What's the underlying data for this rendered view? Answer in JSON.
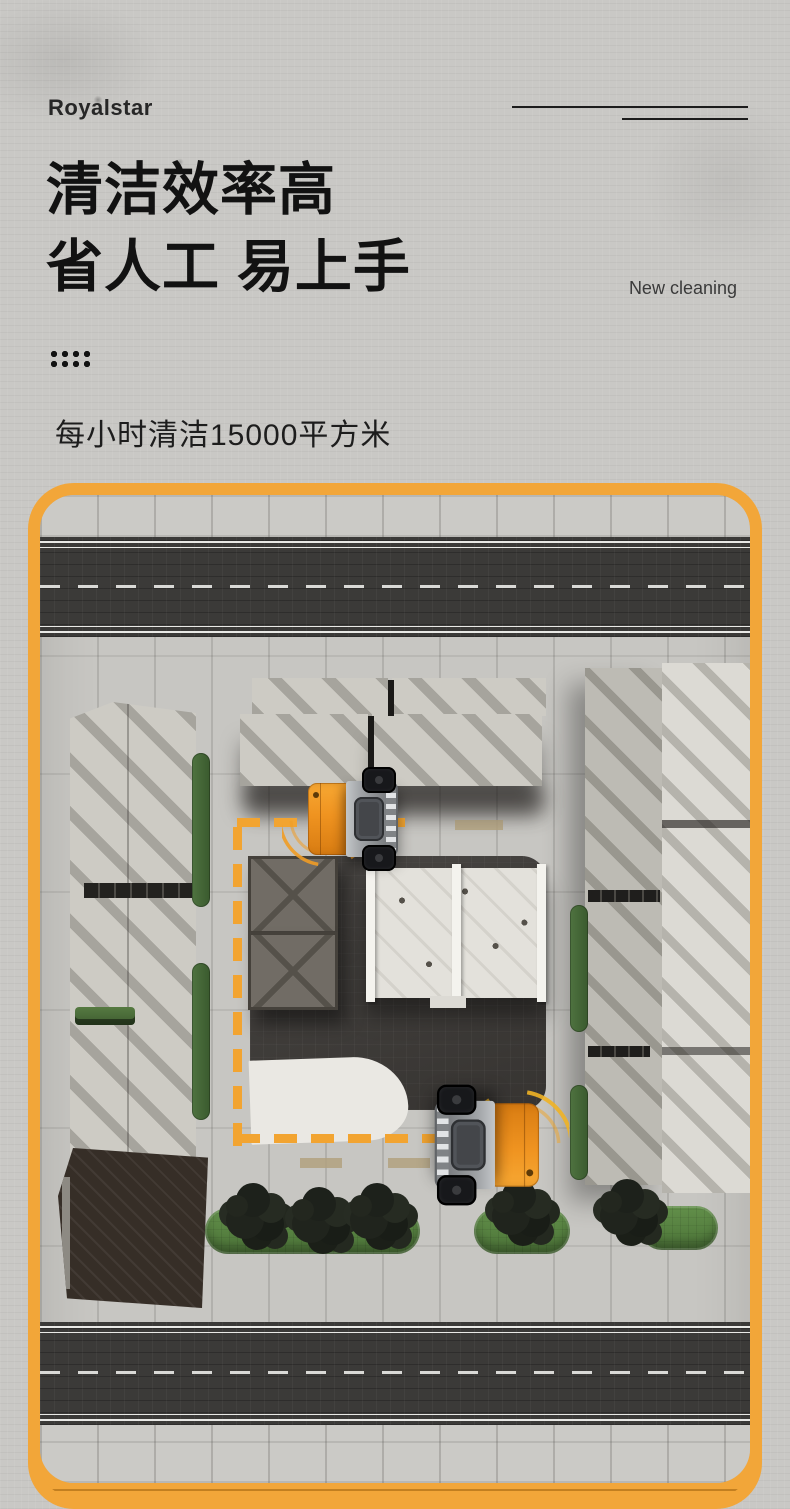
{
  "brand": {
    "logo_text": "Royalstar"
  },
  "hero": {
    "headline": "清洁效率高\n省人工 易上手",
    "tagline": "New cleaning",
    "spec_text": "每小时清洁15000平方米"
  },
  "colors": {
    "frame_yellow": "#F2A639",
    "route_dash_yellow": "#F2A431",
    "vehicle_orange": "#EF9320",
    "road_asphalt": "#3B3A38",
    "plaza_dark": "#3F3C39",
    "greenery_green": "#5D8C47",
    "tree_foliage": "#23271F",
    "pavement_gray": "#C7C6C2",
    "heading_text": "#121212"
  },
  "scene": {
    "object_names": [
      "top-road",
      "bottom-road",
      "left-striped-building",
      "right-striped-building",
      "top-striped-buildings",
      "central-dark-plaza",
      "storage-crates",
      "white-pavilion",
      "curved-white-path",
      "cleaning-route-dashes",
      "sweeper-vehicle-1",
      "sweeper-vehicle-2",
      "green-strips",
      "trees",
      "dark-roof-building"
    ]
  }
}
